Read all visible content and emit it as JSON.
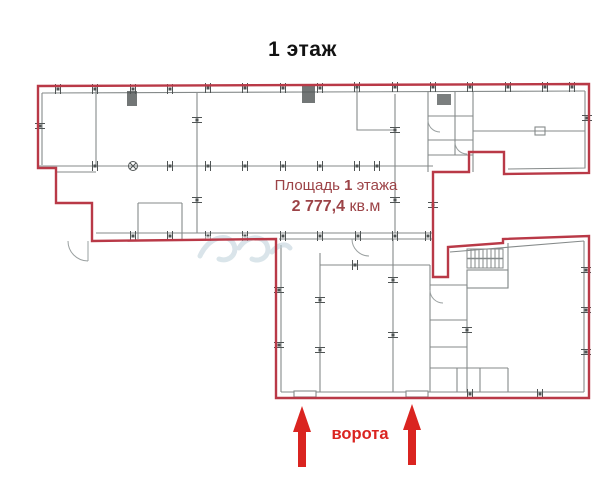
{
  "title": "1 этаж",
  "plan": {
    "area_label": {
      "prefix": "Площадь",
      "floor": "1",
      "suffix": "этажа",
      "value": "2 777,4",
      "unit": "кв.м"
    },
    "gates_label": "ворота"
  },
  "icons": {
    "arrow_left": "up-arrow-icon",
    "arrow_right": "up-arrow-icon"
  },
  "colors": {
    "outline_red": "#b93947",
    "interior_wall_gray": "#858a8a",
    "column_dark": "#4f5454",
    "accent_red": "#da2420",
    "area_text_red": "#9c4347",
    "watermark_blue": "#bccfd9",
    "title_black": "#121212"
  }
}
